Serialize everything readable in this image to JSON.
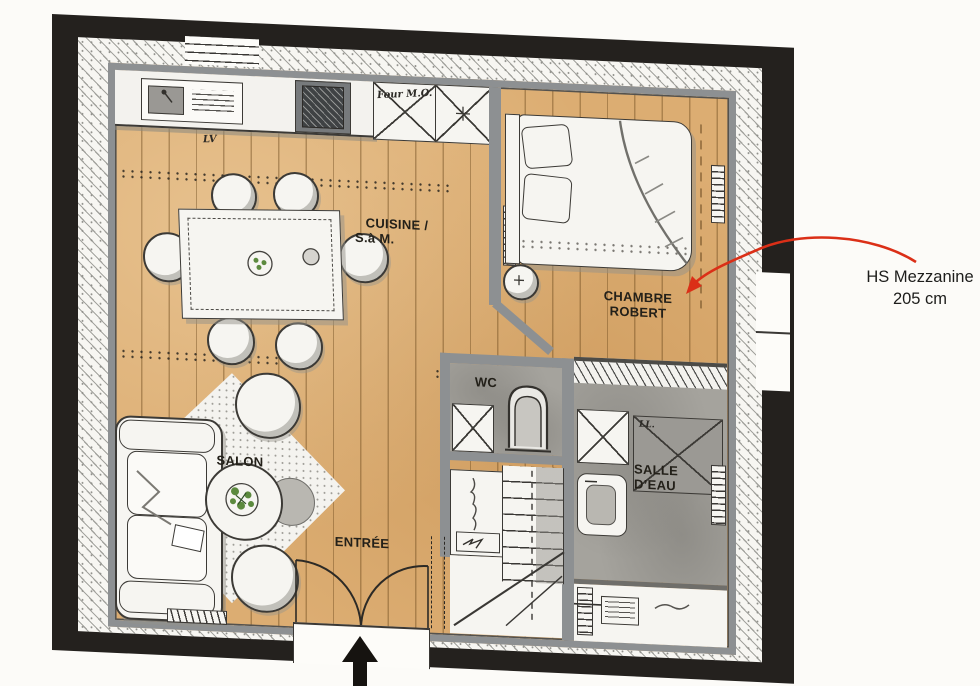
{
  "plan_title": "apartment-floor-plan",
  "rooms": {
    "cuisine": {
      "line1": "CUISINE /",
      "line2": "S.à M."
    },
    "chambre": {
      "line1": "CHAMBRE",
      "line2": "ROBERT"
    },
    "wc": {
      "label": "WC"
    },
    "salle_eau": {
      "line1": "SALLE",
      "line2": "D’EAU"
    },
    "salon": {
      "label": "SALON"
    },
    "entree": {
      "label": "ENTRÉE"
    }
  },
  "handwritten": {
    "dishwasher": "LV",
    "oven_micro": "Four M.O.",
    "washer": "LL."
  },
  "annotation": {
    "line1": "HS Mezzanine",
    "line2": "205 cm"
  },
  "colors": {
    "paper": "#fcfbf8",
    "outer_wall_black": "#24211e",
    "inner_wall_gray": "#8d9092",
    "wood_floor": "#dcad72",
    "tile_gray": "#a5a39d",
    "annotation_red": "#db2f17",
    "plant_green": "#5c8a3e"
  }
}
